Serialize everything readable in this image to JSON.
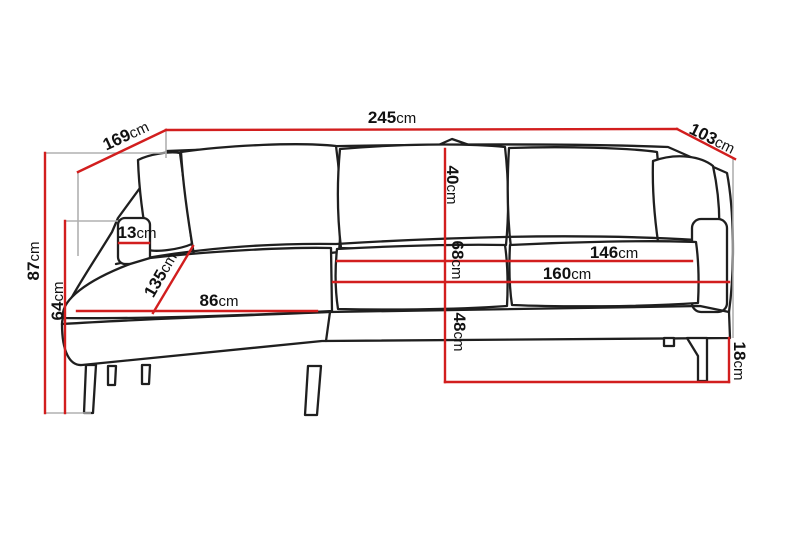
{
  "diagram": {
    "unit": "cm",
    "colors": {
      "dimension_line": "#d21e1e",
      "extension_line": "#b0b0b0",
      "outline": "#1f1f1f",
      "background": "#ffffff"
    },
    "dimensions": {
      "d245": {
        "num": "245",
        "unit": "cm"
      },
      "d169": {
        "num": "169",
        "unit": "cm"
      },
      "d103": {
        "num": "103",
        "unit": "cm"
      },
      "d87": {
        "num": "87",
        "unit": "cm"
      },
      "d64": {
        "num": "64",
        "unit": "cm"
      },
      "d13": {
        "num": "13",
        "unit": "cm"
      },
      "d135": {
        "num": "135",
        "unit": "cm"
      },
      "d86": {
        "num": "86",
        "unit": "cm"
      },
      "d40": {
        "num": "40",
        "unit": "cm"
      },
      "d68": {
        "num": "68",
        "unit": "cm"
      },
      "d48": {
        "num": "48",
        "unit": "cm"
      },
      "d146": {
        "num": "146",
        "unit": "cm"
      },
      "d160": {
        "num": "160",
        "unit": "cm"
      },
      "d18": {
        "num": "18",
        "unit": "cm"
      }
    }
  }
}
